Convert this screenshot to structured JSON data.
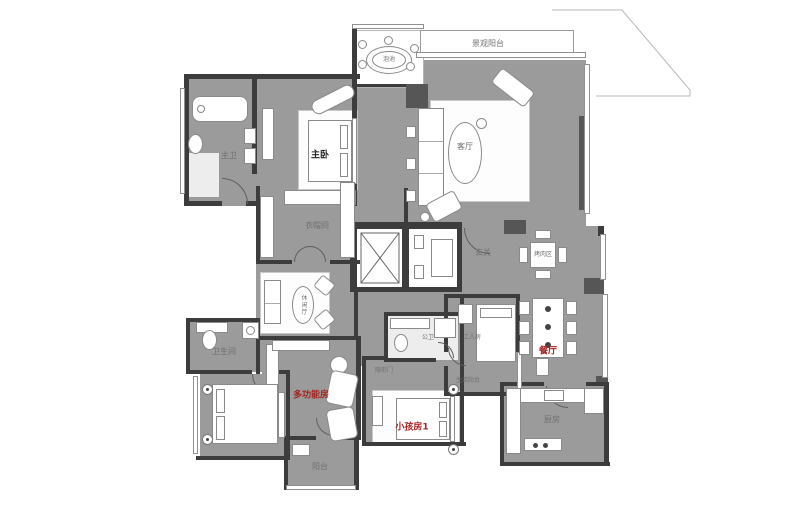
{
  "colors": {
    "floor": "#9b9b9b",
    "wall": "#3c3c3c",
    "outline": "#8a8a8a",
    "label_grey": "#707070",
    "label_red": "#a82320",
    "label_dark": "#222222"
  },
  "labels": {
    "scenic_balcony": "景观阳台",
    "spa": "泡池",
    "living_room": "客厅",
    "master_bedroom": "主卧",
    "master_bath": "主卫",
    "cloakroom": "衣帽间",
    "foyer": "玄关",
    "bbq_area": "烤肉区",
    "dining_room": "餐厅",
    "kitchen": "厨房",
    "leisure_hall": "休闲厅",
    "bathroom": "卫生间",
    "multi_function_room": "多功能房",
    "guest_bath": "公卫",
    "hidden_door": "隐形门",
    "kids_room_1": "小孩房1",
    "worker_room": "工人房",
    "utility_balcony": "生活阳台",
    "balcony": "阳台"
  }
}
